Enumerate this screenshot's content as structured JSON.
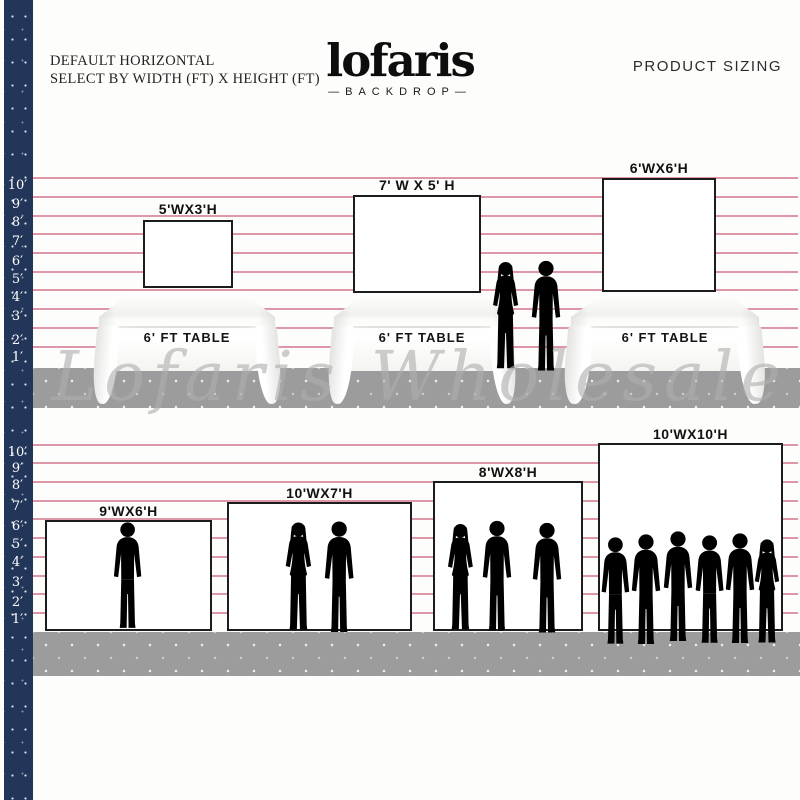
{
  "header": {
    "left_line1": "DEFAULT HORIZONTAL",
    "left_line2": "SELECT BY WIDTH (FT) X HEIGHT (FT)",
    "logo_text": "lofaris",
    "logo_tagline": "—BACKDROP—",
    "right_title": "PRODUCT SIZING"
  },
  "watermark": "Lofaris Wholesale",
  "ruler": {
    "unit": "ft",
    "values": [
      "10′",
      "9′",
      "8′",
      "7′",
      "6′",
      "5′",
      "4′",
      "3′",
      "2′",
      "1′"
    ]
  },
  "top_section": {
    "description": "backdrops shown behind 6 ft tables",
    "backdrops": [
      {
        "label": "5'WX3'H",
        "width_ft": 5,
        "height_ft": 3
      },
      {
        "label": "7' W X 5' H",
        "width_ft": 7,
        "height_ft": 5
      },
      {
        "label": "6'WX6'H",
        "width_ft": 6,
        "height_ft": 6
      }
    ],
    "tables": [
      {
        "label": "6' FT TABLE"
      },
      {
        "label": "6' FT TABLE"
      },
      {
        "label": "6' FT TABLE"
      }
    ],
    "people_between_tables": 2
  },
  "bottom_section": {
    "description": "backdrops shown with standing people",
    "backdrops": [
      {
        "label": "9'WX6'H",
        "width_ft": 9,
        "height_ft": 6,
        "people_count": 1
      },
      {
        "label": "10'WX7'H",
        "width_ft": 10,
        "height_ft": 7,
        "people_count": 2
      },
      {
        "label": "8'WX8'H",
        "width_ft": 8,
        "height_ft": 8,
        "people_count": 3
      },
      {
        "label": "10'WX10'H",
        "width_ft": 10,
        "height_ft": 10,
        "people_count": 6
      }
    ]
  },
  "colors": {
    "navy_strip": "#22365a",
    "guide_line_pink": "#d67d91",
    "floor_gray": "#9c9c9c",
    "silhouette_gray": "#b5b5b5",
    "box_border": "#1c1c1c"
  }
}
